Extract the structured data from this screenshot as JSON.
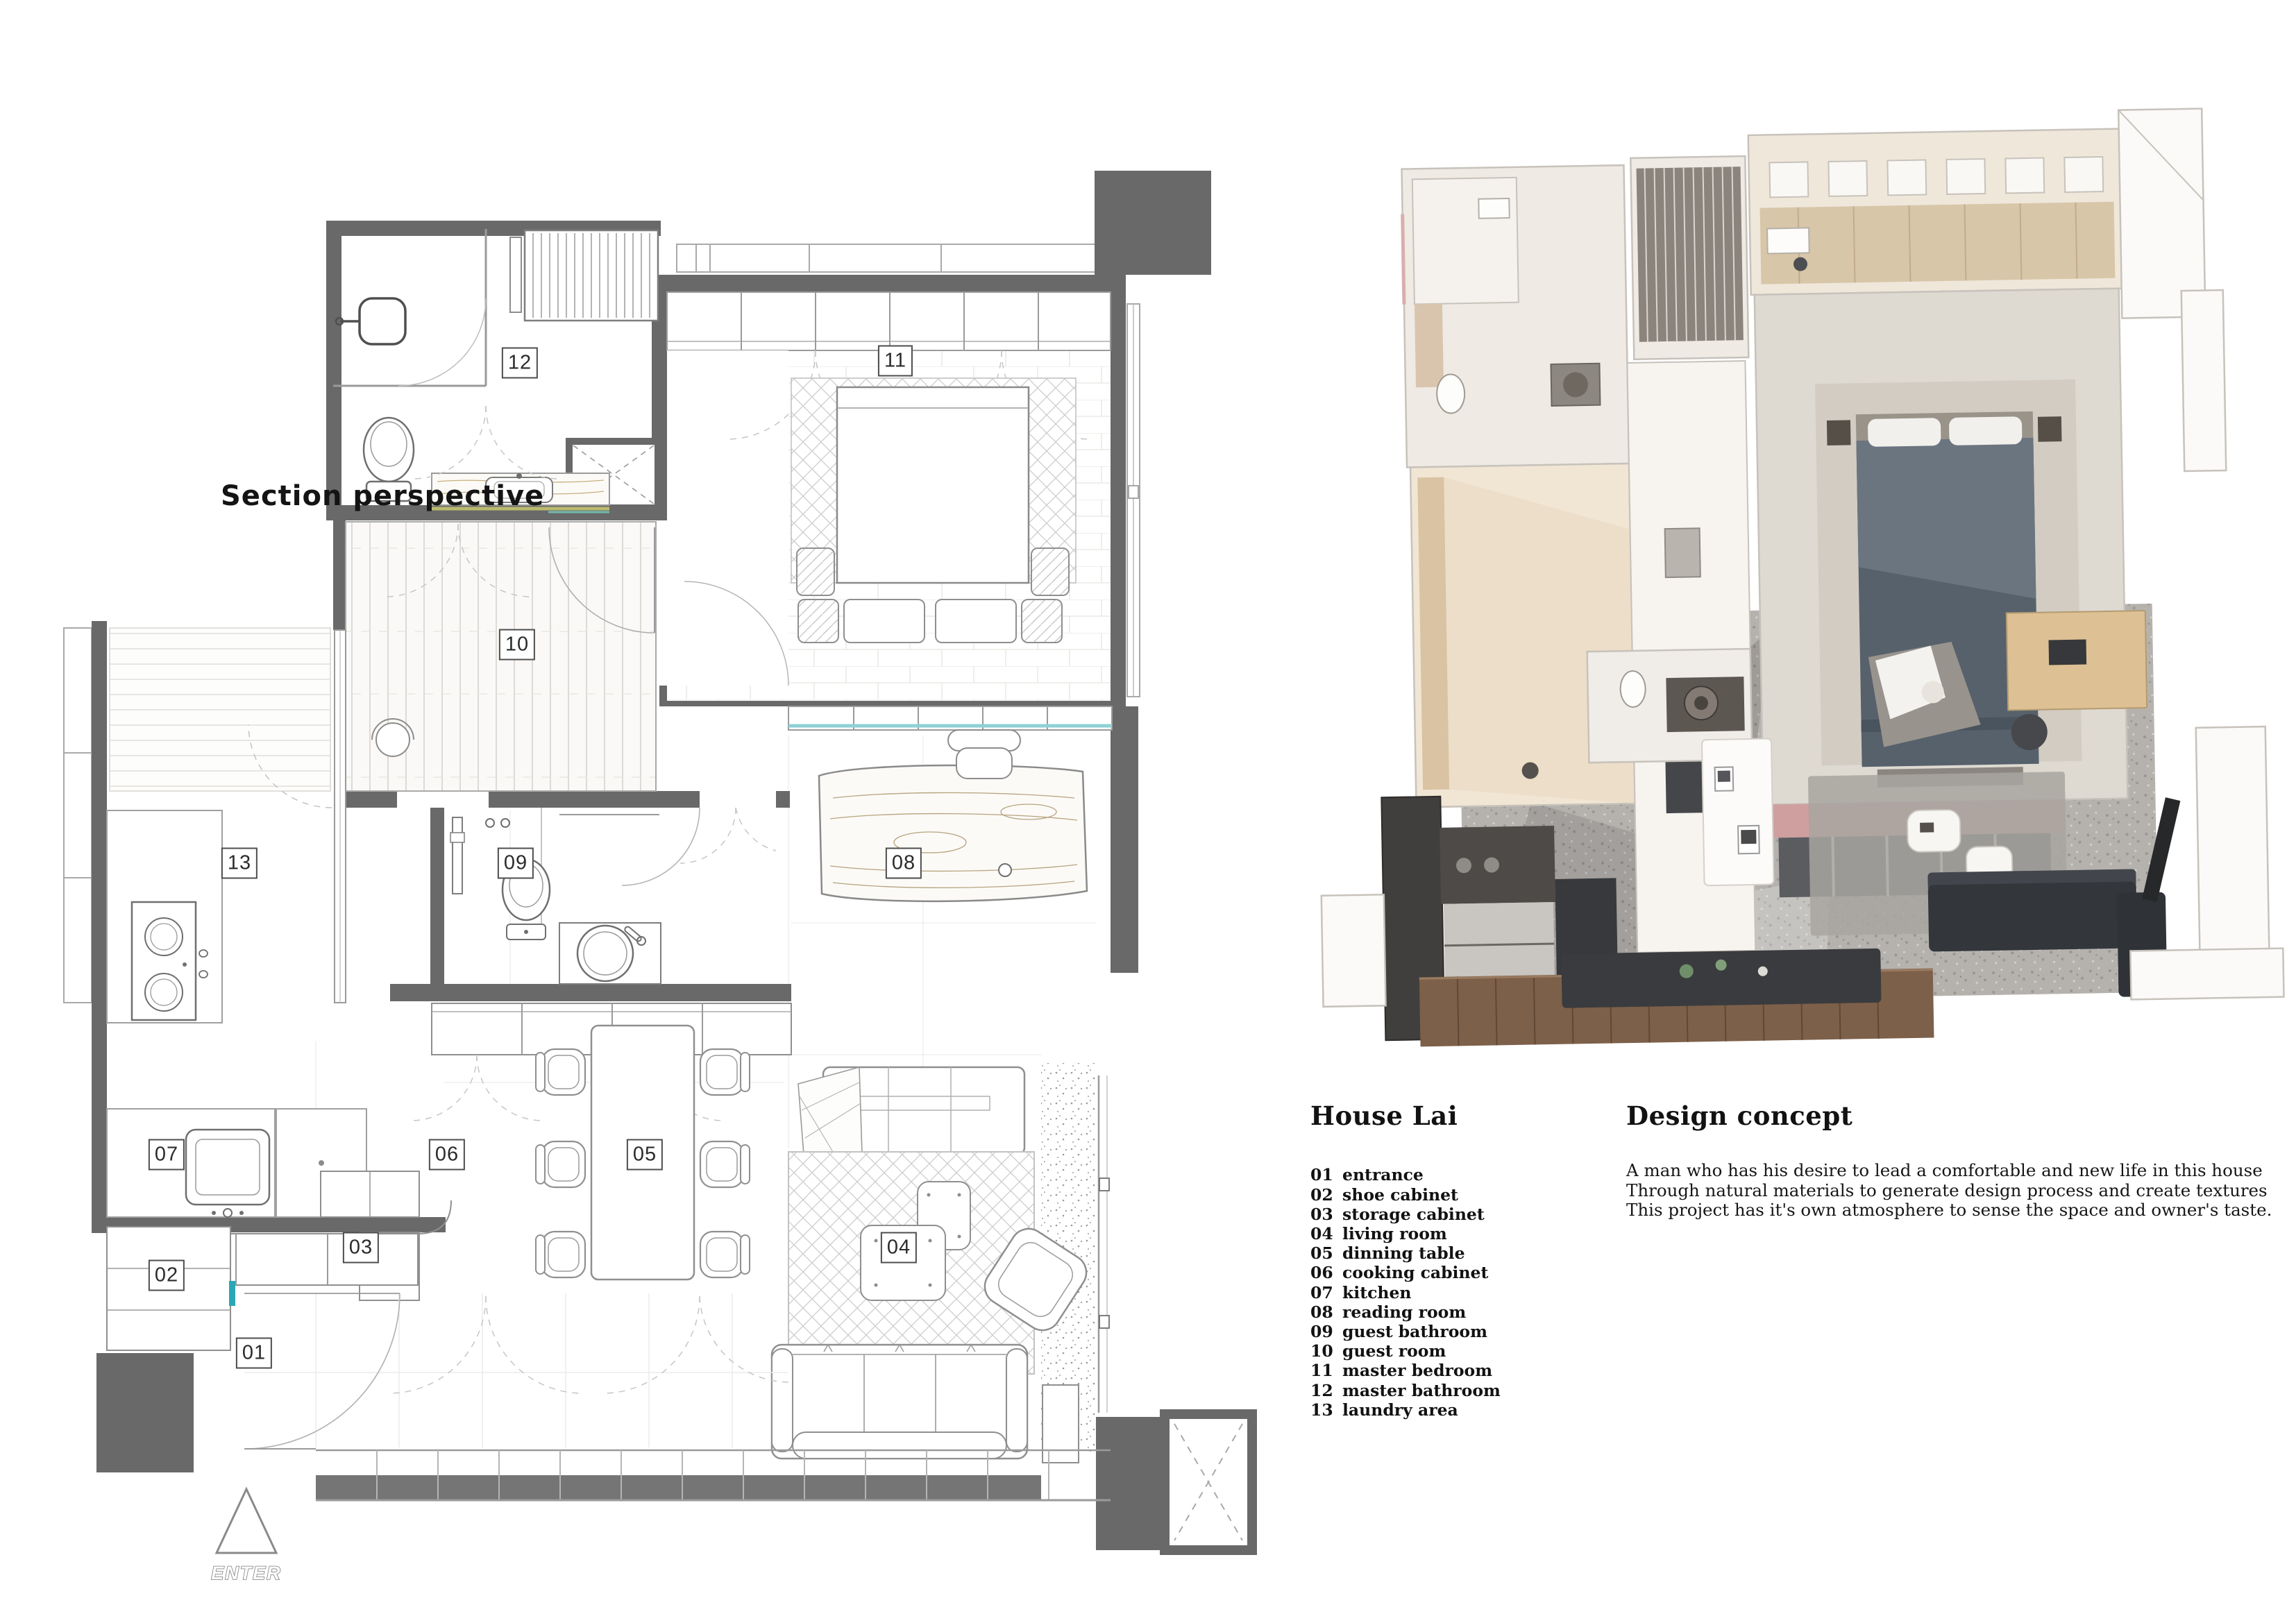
{
  "plan": {
    "section_label": "Section perspective",
    "enter_label": "ENTER"
  },
  "legend": {
    "title": "House Lai",
    "items": [
      {
        "code": "01",
        "name": "entrance"
      },
      {
        "code": "02",
        "name": "shoe cabinet"
      },
      {
        "code": "03",
        "name": "storage cabinet"
      },
      {
        "code": "04",
        "name": "living room"
      },
      {
        "code": "05",
        "name": "dinning table"
      },
      {
        "code": "06",
        "name": "cooking cabinet"
      },
      {
        "code": "07",
        "name": "kitchen"
      },
      {
        "code": "08",
        "name": "reading room"
      },
      {
        "code": "09",
        "name": "guest bathroom"
      },
      {
        "code": "10",
        "name": "guest room"
      },
      {
        "code": "11",
        "name": "master bedroom"
      },
      {
        "code": "12",
        "name": "master bathroom"
      },
      {
        "code": "13",
        "name": "laundry area"
      }
    ]
  },
  "design_concept": {
    "title": "Design concept",
    "lines": [
      "A man who has his desire to lead a comfortable and new life in this house",
      "Through natural materials to generate design process and create textures",
      "This project has it's own atmosphere to sense the space and owner's taste."
    ]
  },
  "colors": {
    "wall_gray": "#696969",
    "accent_teal": "#2aa7b5",
    "accent_olive": "#b9ba6e",
    "window_glass": "#8fd0d6",
    "render_bed": "#57616c",
    "render_plant": "#a6c4a8",
    "render_terrazzo": "#b5b2ae",
    "render_wood_floor": "#7d604a",
    "render_pink_shelf": "#cf9f9f"
  }
}
